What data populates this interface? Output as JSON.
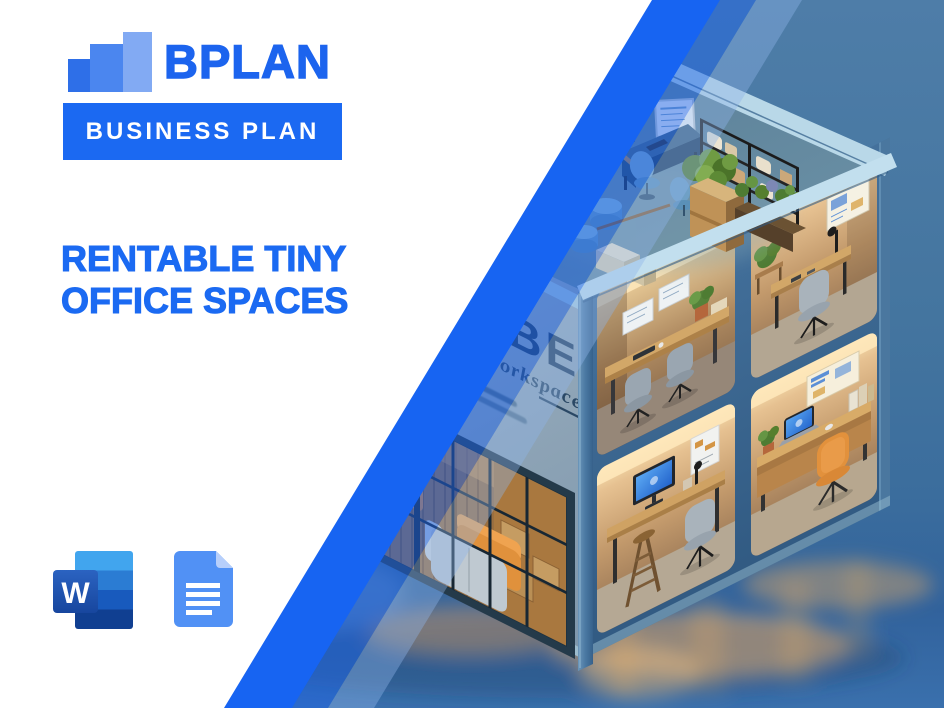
{
  "brand": {
    "name": "BPLAN",
    "banner": "BUSINESS PLAN",
    "bar_colors": [
      "#2e6fe8",
      "#4b86ef",
      "#82aaf3"
    ],
    "primary_color": "#1c64ee"
  },
  "title": {
    "line1": "RENTABLE TINY",
    "line2": "OFFICE SPACES",
    "color": "#1b6af2"
  },
  "file_icons": {
    "word_letter": "W",
    "word_icon": "microsoft-word-icon",
    "docs_icon": "google-docs-icon"
  },
  "illustration": {
    "alt": "Isometric 3D cutaway of a cube-shaped building with four warm-lit tiny office cubicles, a rooftop workspace with plants and shelving, and a glass-walled lounge with sofas",
    "sign_title": "CUBE",
    "sign_subtitle": "Workspace",
    "stripe_color": "#1764f2",
    "background_color": "#44759f"
  }
}
